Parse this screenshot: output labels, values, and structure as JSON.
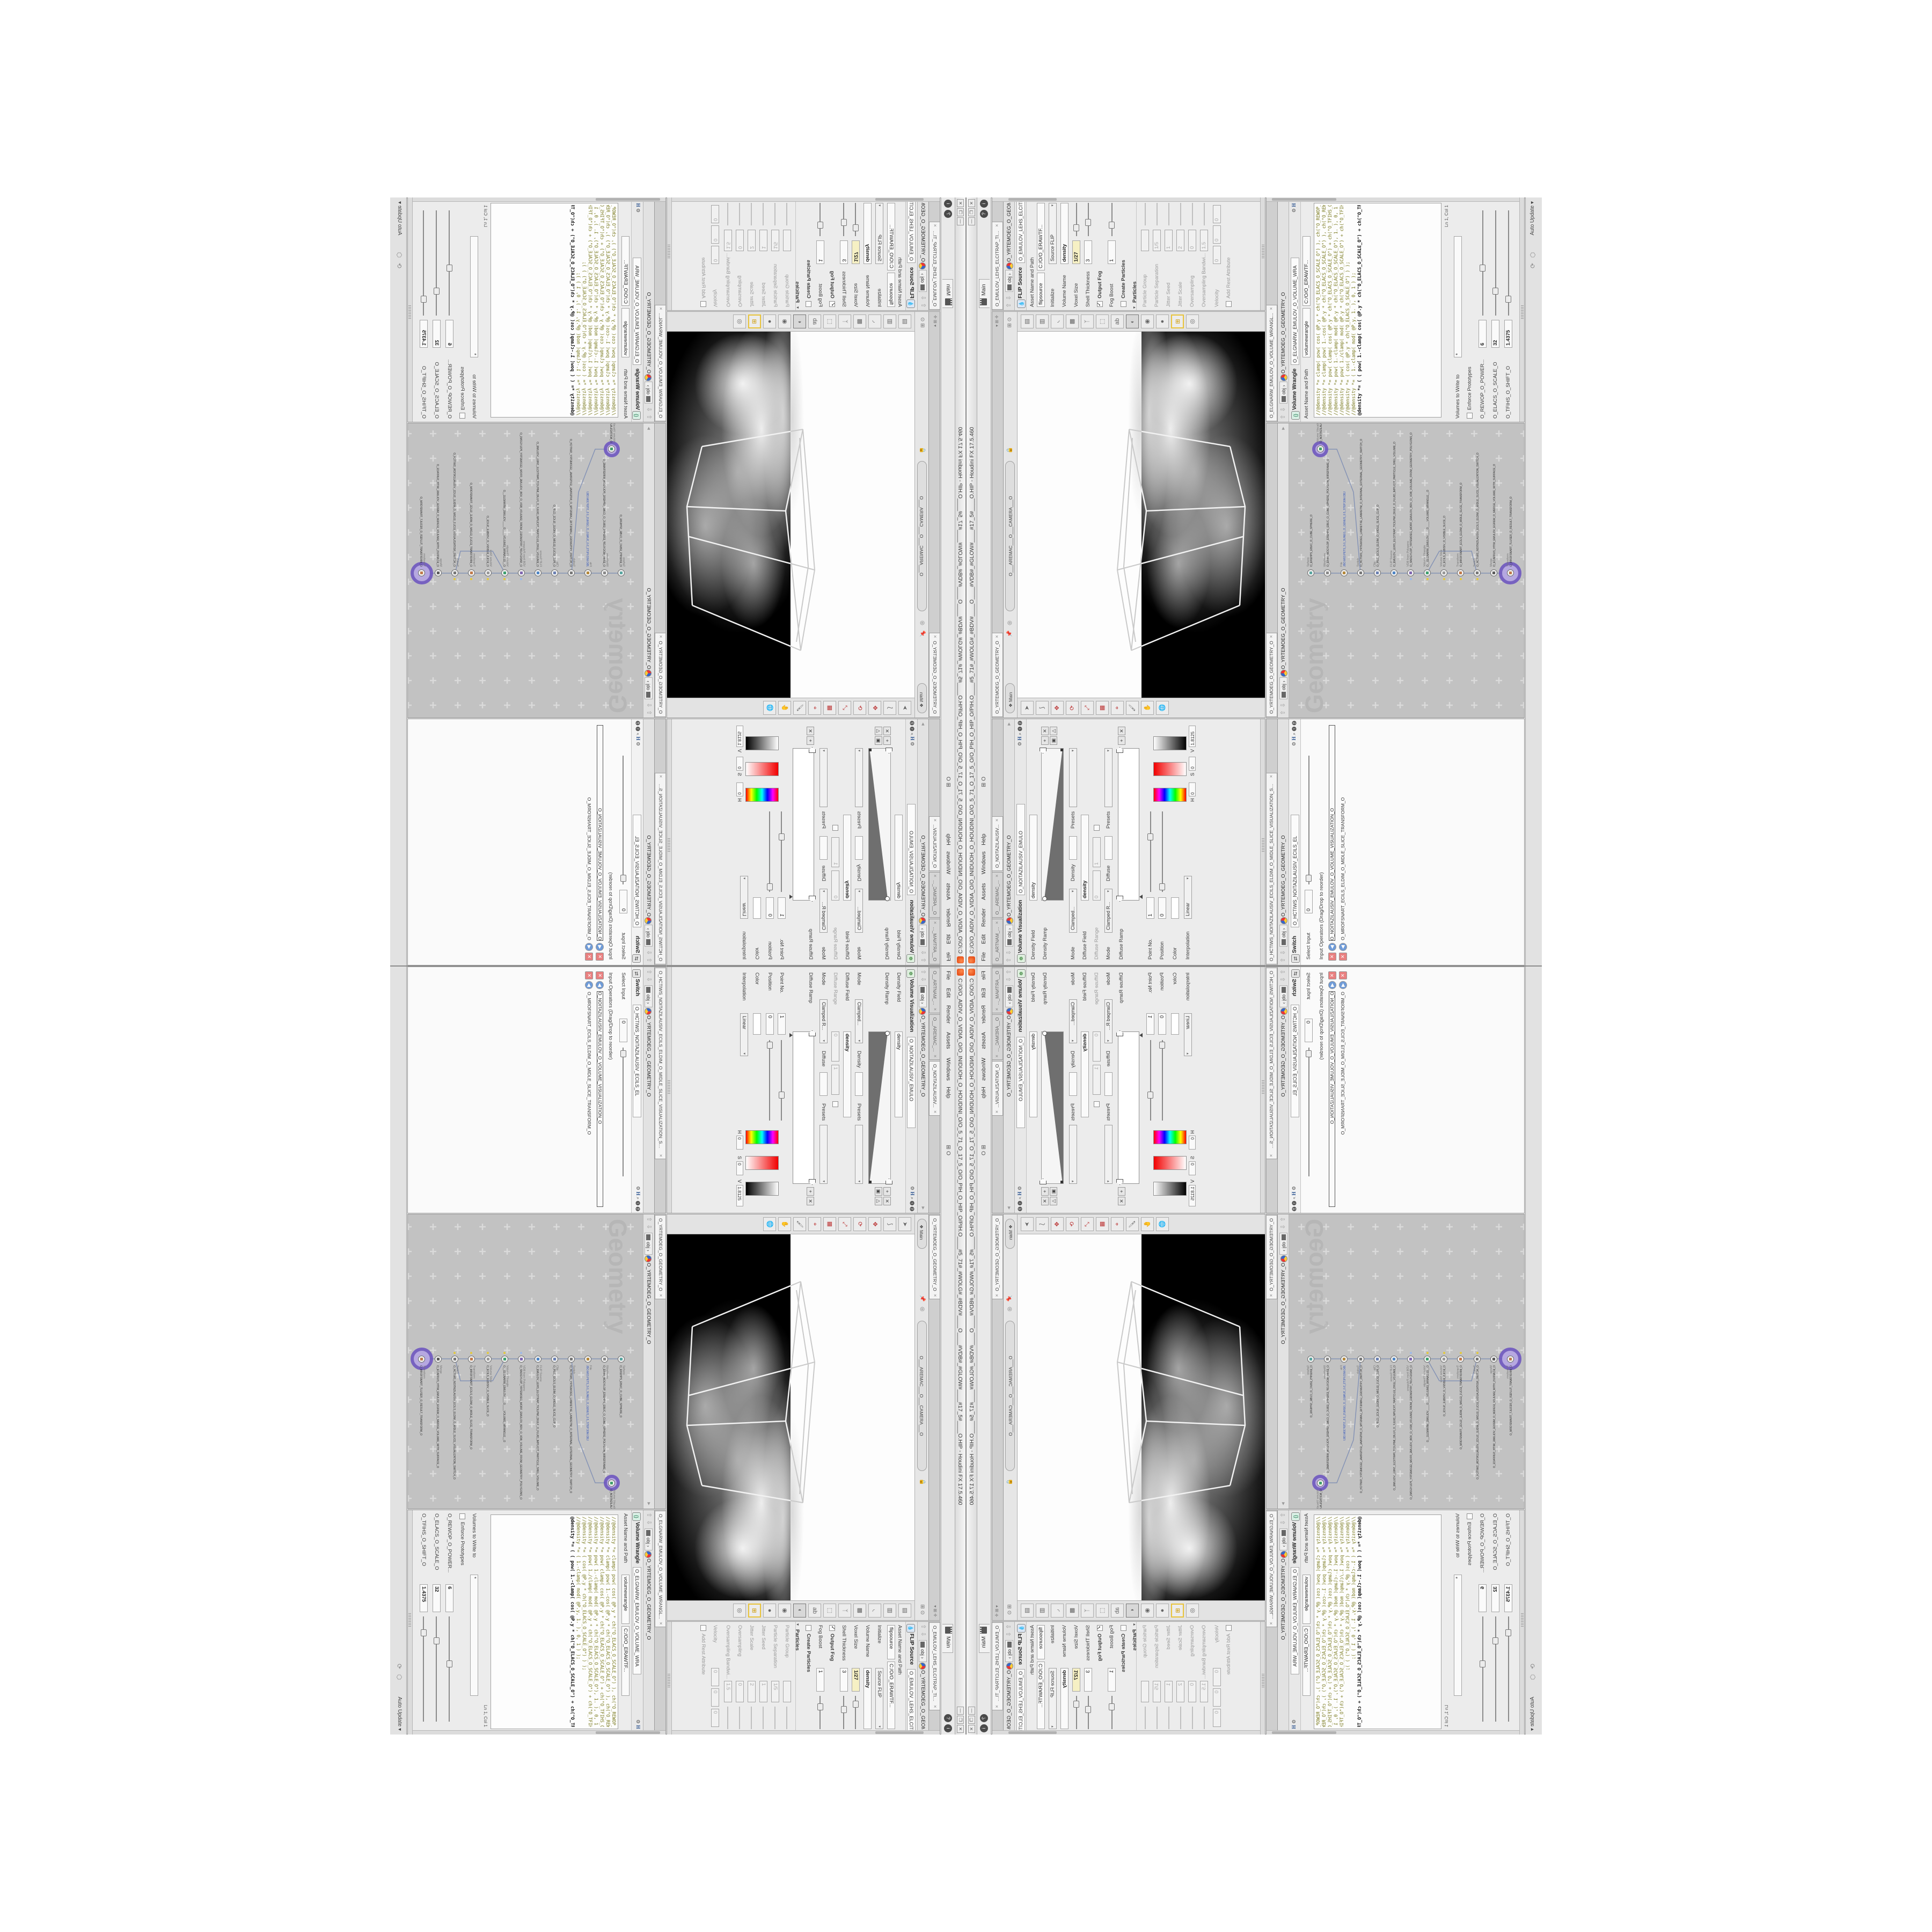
{
  "window": {
    "title": "C:/O/O_AIDIV_O_VIDIA_O/O_INIDUOH_O_HOUDINI_O/O_5_71_O_17_5_O/O_PIH_O_HIP_O/PIH.O____#5_71#_#WOLG#_#BDV#____O____#VDB#_#GLOW#____#17_5#____O.HIP - Houdini FX 17.5.460",
    "buttons": {
      "minimize": "—",
      "maximize": "❐",
      "close": "✕"
    },
    "menus": [
      "File",
      "Edit",
      "Render",
      "Assets",
      "Windows",
      "Help"
    ],
    "menu_extra": "O",
    "desktop_tab": "Main",
    "help_icons": [
      "?",
      "i"
    ]
  },
  "paths": {
    "root": "obj",
    "node": "O_YRTEMOEG_O_GEOMETRY_O"
  },
  "volviz_pane": {
    "tabs": [
      "O__ARTNAM_...",
      "O__AREMAC_...",
      "O_NOITAZILAUSIV..."
    ],
    "type_label": "Volume Visualization",
    "name_value": "O_NOITAZILAUSIV_EMULO",
    "density_field_label": "Density Field",
    "density_field_value": "density",
    "density_ramp_label": "Density Ramp",
    "mode_label": "Mode",
    "mode_value": "Clamped...",
    "density_label": "Density",
    "presets_label": "Presets",
    "diffuse_field_label": "Diffuse Field",
    "diffuse_field_value": "density",
    "diffuse_range_label": "Diffuse Range",
    "diffuse_range_min": "0",
    "diffuse_range_max": "1",
    "mode2_value": "Clamped R...",
    "diffuse_label": "Diffuse",
    "diffuse_ramp_label": "Diffuse Ramp",
    "point_no_label": "Point No.",
    "point_no_value": "1",
    "position_label": "Position",
    "position_value": "0",
    "color_label": "Color",
    "interpolation_label": "Interpolation",
    "interpolation_value": "Linear",
    "hsv": [
      {
        "label": "H",
        "value": "0"
      },
      {
        "label": "S",
        "value": "0"
      },
      {
        "label": "V",
        "value": "1.8125"
      }
    ]
  },
  "viewport_pane": {
    "tab": "O_YRTEMOEG_O_GEOMETRY_O",
    "main_pill": "Main",
    "camera_pill": "O___AREMAC___O___CAMERA___O",
    "left_tools": [
      "select-arrow-icon",
      "lasso-icon",
      "move-handles-icon",
      "rotate-handles-icon",
      "scale-handles-icon",
      "snap-grid-magnet-icon",
      "snap-point-magnet-icon",
      "paint-icon",
      "view-pan-icon",
      "view-orbit-icon"
    ],
    "right_tools": [
      "page-icon",
      "pages-icon",
      "falloff-curve-icon",
      "checker-cube-icon",
      "three-way-icon",
      "cage-icon",
      "text-abc-icon",
      "gradient-sphere-icon",
      "eye-pointer-icon",
      "dark-sphere-icon",
      "grid-quad-icon",
      "orbit-sphere-icon"
    ]
  },
  "flip_pane": {
    "tab": "O_EMULOV_LEHS_ELCITRAP_TICILPMI_DIULF_O_FLUID_IMPLICIT_PARTI...",
    "type_label": "FLIP Source",
    "name_value": "O_EMULOV_LEHS_ELCITRAP_TICI",
    "asset_label": "Asset Name and Path",
    "asset_name_value": "flipsource",
    "asset_path_value": "C:/O/O_ERAWTF...",
    "initialize_label": "Initialize",
    "initialize_value": "Source FLIP",
    "volume_name_label": "Volume Name",
    "volume_name_value": "density",
    "voxel_size_label": "Voxel Size",
    "voxel_size_value": "1/27",
    "shell_label": "Shell Thickness",
    "shell_value": "3",
    "output_fog_label": "Output Fog",
    "fog_boost_label": "Fog Boost",
    "fog_boost_value": "1",
    "create_particles_label": "Create Particles",
    "particles_section_label": "Particles",
    "particle_rows": [
      {
        "label": "Particle Group",
        "value": ""
      },
      {
        "label": "Particle Separation",
        "value": "1/5"
      },
      {
        "label": "Jitter Seed",
        "value": "1"
      },
      {
        "label": "Jitter Scale",
        "value": "2"
      },
      {
        "label": "Oversampling",
        "value": "0"
      },
      {
        "label": "Oversampling Bandwi...",
        "value": "1.5"
      }
    ],
    "velocity_label": "Velocity",
    "velocity_values": [
      "0",
      "0",
      "0"
    ],
    "add_rest_label": "Add Rest Attribute"
  },
  "switch_pane": {
    "tab": "O_HCTIWS_NOITAZILAUSIV_ECILS_ELDIM_O_MIDLE_SLICE_VISUALIZATION_SWI...",
    "type_label": "Switch",
    "name_value": "O_HCTIWS_NOITAZILAUSIV_ECILS_EL",
    "select_input_label": "Select Input",
    "select_input_value": "0",
    "operators_label": "Input Operators (Drag/Drop to reorder)",
    "items": [
      "O_NOITAZILAUSIV_EMULOV_O_VOLUME_VISUALIZATION_O",
      "O_MROFSNART_ECILS_ELDIM_O_MIDLE_SLICE_TRANSFORM_O"
    ]
  },
  "wrangle_pane": {
    "tab": "O_ELGNARW_EMULOV_O_VOLUME_WRANGL...",
    "type_label": "Volume Wrangle",
    "name_value": "O_ELGNARW_EMULOV_O_VOLUME_WRA",
    "asset_label": "Asset Name and Path",
    "asset_name_value": "volumewrangle",
    "asset_path_value": "C:/O/O_ERAWTF...",
    "code_lines": [
      "//@density *= clamp( pow( cos( @P.y * ch(\"O_ELACS_O_SCALE_O\") ), ch(\"O_REWOP_O_POWER_O\") ), 0, 1 );",
      "//@density *= clamp( pow( 1.-cos( @P.y * ch(\"O_ELACS_O_SCALE_O\") ), ch(\"O_REWOP_O_POWER_O\") ), 0, 1 );",
      "//@density *= pow( clamp( cos( @P.y * ch(\"O_ELACS_O_SCALE_O\") + ch(\"O_TFIHS_O_SHIFT_O\") ), 0, 1 ), ch(\"O_REWOP_O_POWER_O\") );",
      "//@density *= pow( 1.-clamp( mod( @P.y * ch(\"O_ELACS_O_SCALE_O\"), 1. ), 0, 1 ), ch(\"O_REWOP_O_POWER_O\") );",
      "//@density *= pow( 1./clamp( mod( @P.y * ch(\"O_ELACS_O_SCALE_O\") + ch(\"O_TFIHS_O_SHIFT_O\"), 1. ), 0, 1 ), ch(\"O_REWOP_O_POWER_O\") );",
      "//@density *= ( cos( @P.y * ch(\"O_ELACS_O_SCALE_O\") ) );",
      "//@density *= ( 1.-clamp( mod( @P.y, 1. ), 0, 1 ) );",
      "@density *= ( ( pow( 1.-clamp( cos( @P.y * ch(\"O_ELACS_O_SCALE_O\") + ch(\"O_TFIHS_O_SHIFT_O\") ), 0, 1 ), ch(\"O_REWOP_O_POWER_O\") ) ) );"
    ],
    "lncol": "Ln 1, Col 1",
    "volumes_label": "Volumes to Write to",
    "volumes_value": "*",
    "enforce_label": "Enforce Prototypes",
    "sliders": [
      {
        "label": "O_REWOP_O_POWER...",
        "value": "6",
        "pos": 0.42
      },
      {
        "label": "O_ELACS_O_SCALE_O",
        "value": "32",
        "pos": 0.2
      },
      {
        "label": "O_TFIHS_O_SHIFT_O",
        "value": "1.4375",
        "pos": 0.12
      }
    ]
  },
  "network_pane": {
    "tab": "O_YRTEMOEG_O_GEOMETRY_O",
    "watermark": "Geometry",
    "nodes": [
      {
        "type": "Sphere",
        "name": "O_EREHPS_EBUC_O_CUBE_SPHERE_O",
        "color": "#58a6a0"
      },
      {
        "type": "Wireframe",
        "name": "O_ERIW_NOGYLOP_EREHPS_EBUC_O_CUBE_SPHERE_POLYGON_WIREFRAME_O",
        "color": "#888888"
      },
      {
        "type": "File",
        "name": "JBO.M03.PETS_5.0_SUNEG_O_GENUS_0.5_STEP.30M.OBJ",
        "color": "#b5893c",
        "blue": true
      },
      {
        "type": "Switch",
        "name": "O_HCTIWS_YRTEMOEG_LANRETXE_LANRETNI_O_INTERNAL_EXTERNAL_GEOMETRY_SWITCH_O",
        "color": "#777777"
      },
      {
        "type": "Clip",
        "name": "O_PILC_ECILS_ELDIM_O_MIDLE_SLICE_CLIP_O",
        "color": "#6a7fb2"
      },
      {
        "type": "FLIP Source",
        "name": "O_EMULOV_LEHS_ELCITRAP_TICILPMI_DIULF_O_FLUID_IMPLICIT_PARTICLE_SHEL_VOLUME_O",
        "color": "#4f86c6"
      },
      {
        "type": "VDB from Polygons",
        "name": "O_SNOGYLOP_YRTEMOEG_MORF_EMULOV_BDV_O_VDB_VOLUME_FROM_GEOMETRY_POLYGONS_O",
        "color": "#7f66b0",
        "flag": "blue"
      },
      {
        "type": "Volume Wrangle",
        "name": "O__ELGNARW_EMULOV____O____VOLUME_WRANGLE__O",
        "color": "#3e9f6e",
        "flag": "yellow"
      },
      {
        "type": "Volume Slice",
        "name": "O_ECILS_ELBISIV_O_VISIBLE_SLICE_O",
        "color": "#999999",
        "flag": "yellow"
      },
      {
        "type": "Transform",
        "name": "O_MROFSNART_ECILS_ELDIM_O_MIDLE_SLICE_TRANSFORM_O",
        "color": "#c07a4a",
        "flag": "yellow"
      },
      {
        "type": "Switch",
        "name": "O_HCTIWS_NOITAZILAUSIV_ECILS_ELDIM_O_MIDLE_SLICE_VISUALIZATION_SWITCH_O",
        "color": "#777777",
        "flag": "yellow"
      },
      {
        "type": "Merge",
        "name": "O_ECAFRUS_HTIW_EMULOV_EGREM_O_MERGE_VOLUME_WITH_SURFACE_O",
        "color": "#5b5b5b"
      },
      {
        "type": "Transform",
        "name": "O_MROFSNART_TLUSER_O_RESULT_TRANSFORM_O",
        "color": "#c07a4a",
        "halo": true
      }
    ],
    "side_node": {
      "type": "Volume Visualization",
      "name": "O_NOITAZILAUSIV_EMULOV_O_VOLUME_VISUALIZATION_O",
      "color": "#3fa06a",
      "halo": true
    }
  },
  "status": {
    "auto_update": "Auto Update",
    "icons": [
      "refresh-cycle-icon",
      "cook-nut-icon"
    ]
  },
  "colors": {
    "pane_bg": "#ececec",
    "network_bg": "#c2c2c2",
    "expression_field": "#f6f0c4",
    "accent_purple": "#6f58c0",
    "node_flag_yellow": "#e4c93c",
    "app_orange": "#e8541d",
    "code_olive": "#7a7a1e",
    "viewport_black": "#000000",
    "viewport_white": "#fdfdfd"
  }
}
